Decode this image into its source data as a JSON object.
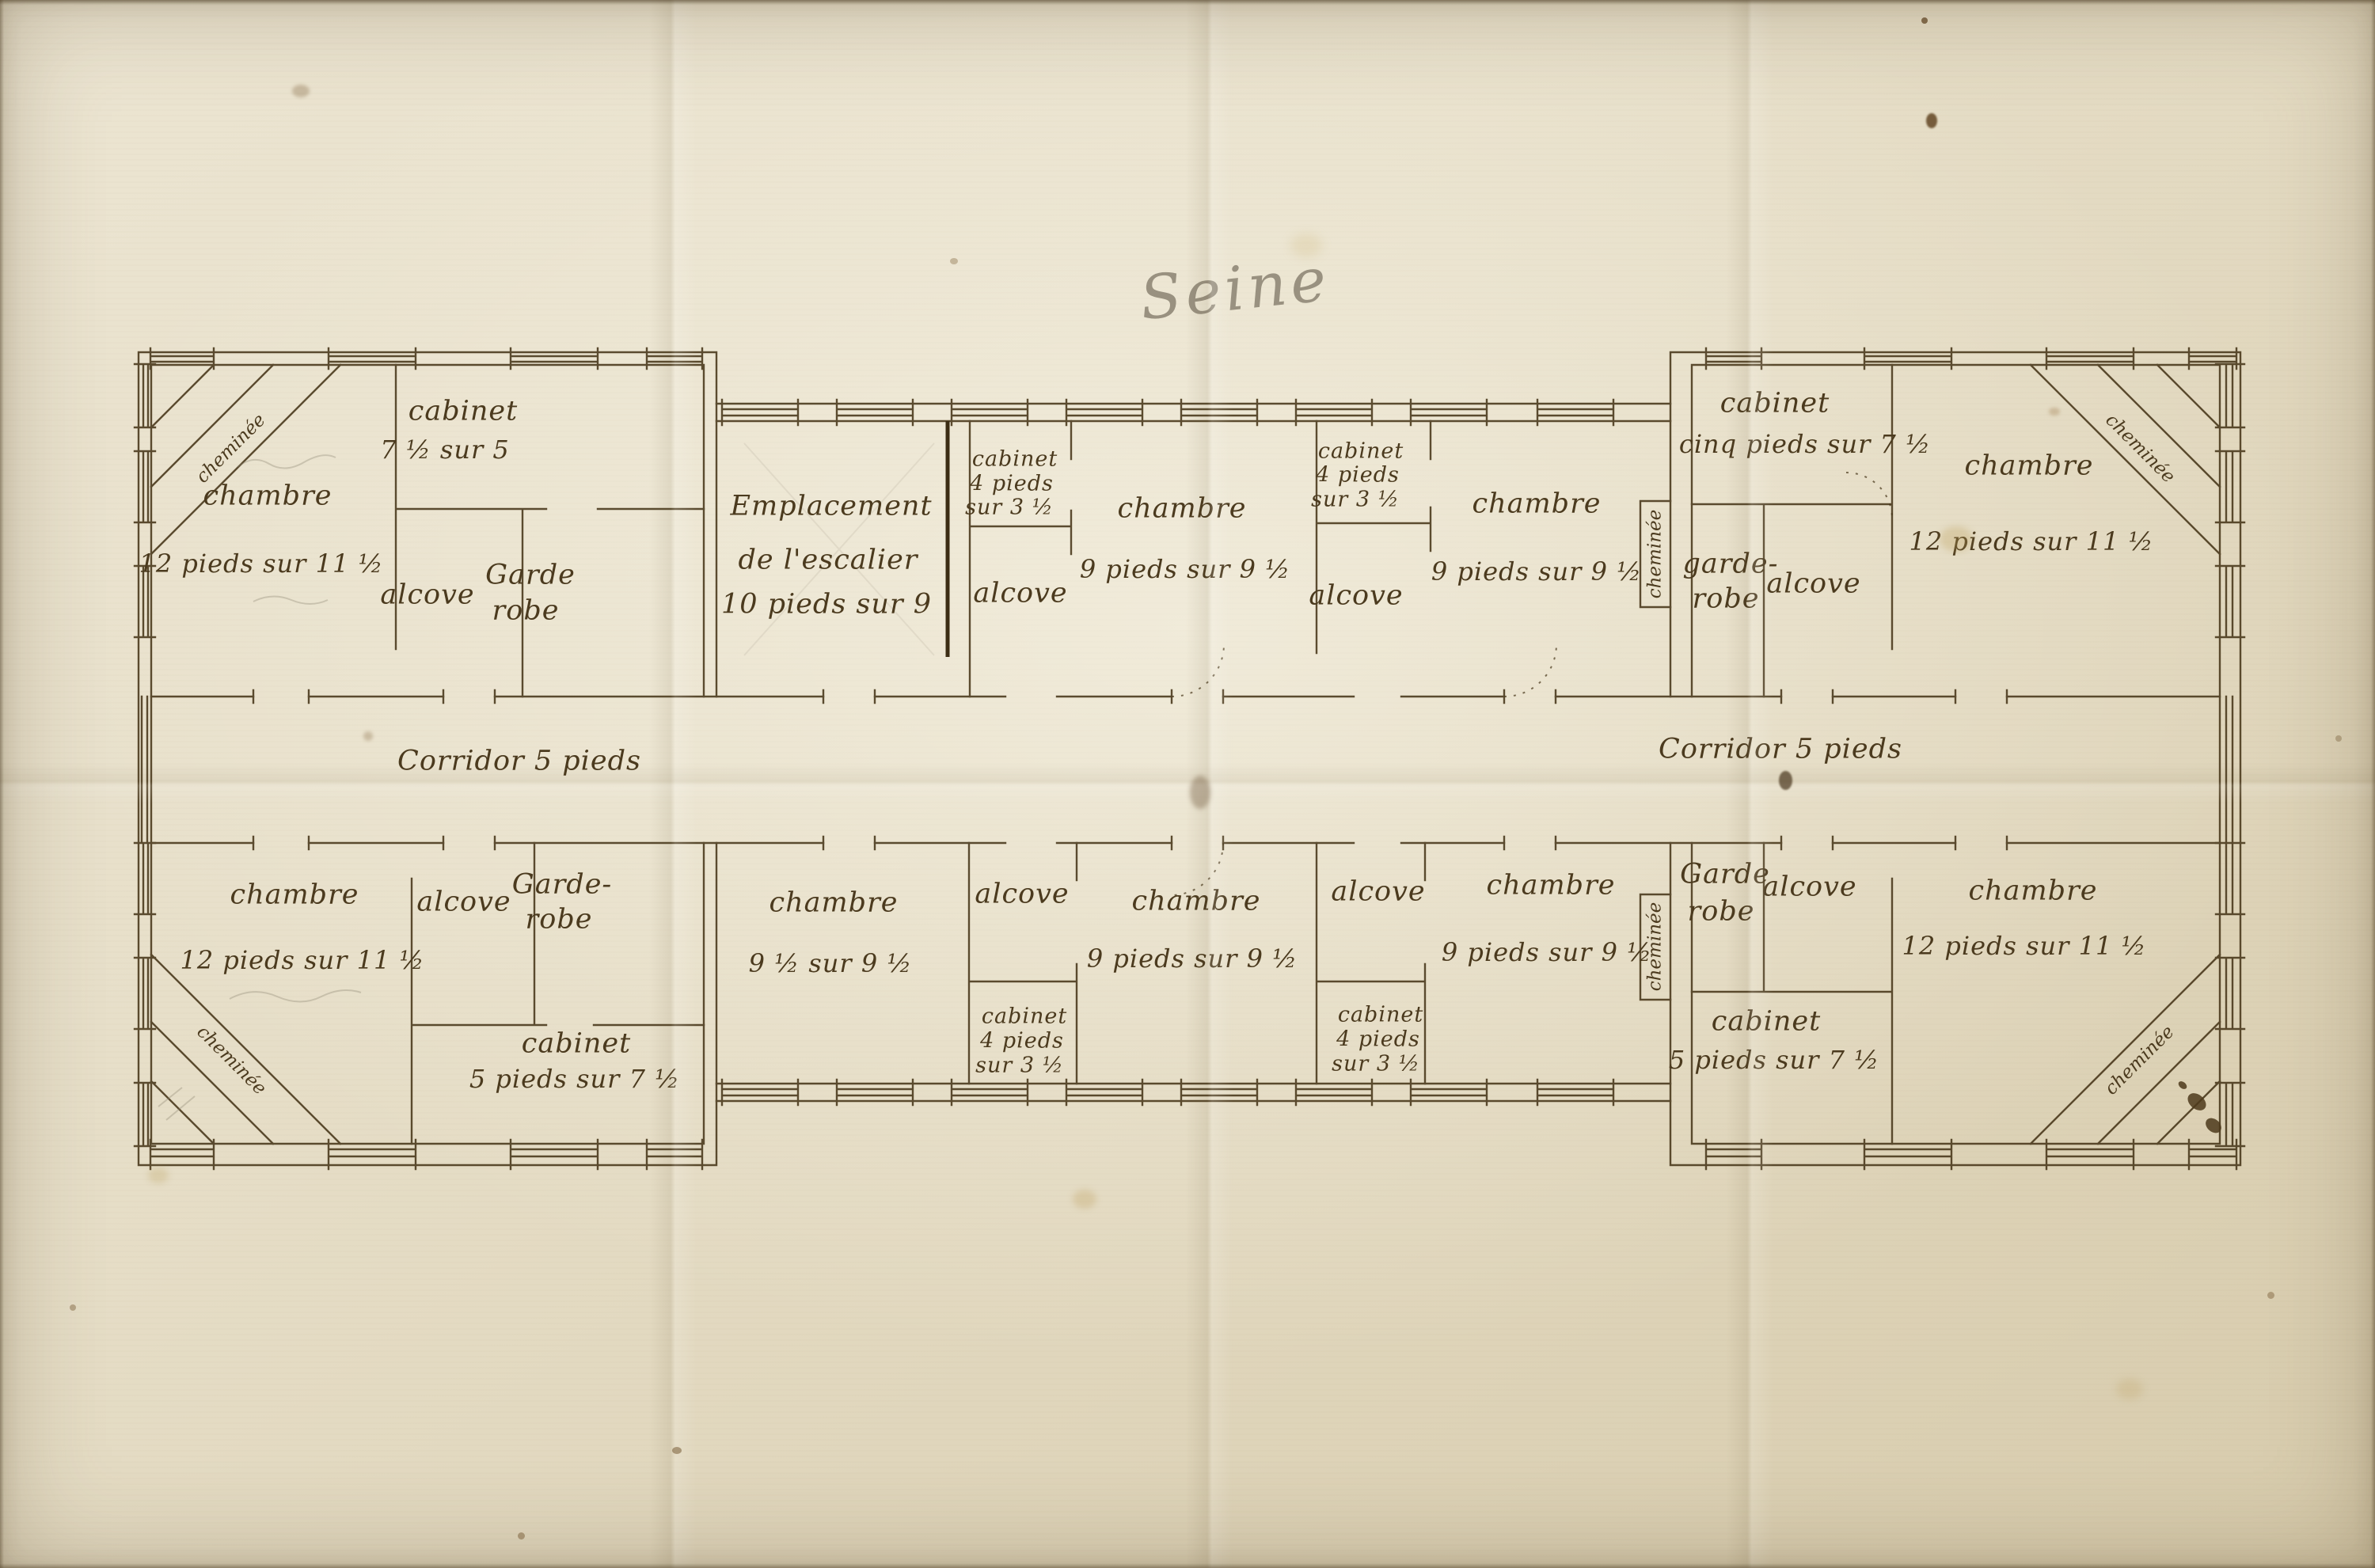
{
  "title": "Seine",
  "palette": {
    "paper": "#e7dfc9",
    "ink": "#4b3a1e",
    "pencil": "#8b8372"
  },
  "corridor": {
    "left": "Corridor 5 pieds",
    "right": "Corridor 5 pieds"
  },
  "chimney_label": "cheminée",
  "rooms": {
    "tl_cabinet": {
      "name": "cabinet",
      "dims": "7 ½ sur 5"
    },
    "tl_chambre": {
      "name": "chambre",
      "dims": "12 pieds sur 11 ½"
    },
    "tl_alcove": {
      "name": "alcove"
    },
    "tl_garderobe": {
      "line1": "Garde",
      "line2": "robe"
    },
    "stair": {
      "line1": "Emplacement",
      "line2": "de l'escalier",
      "line3": "10 pieds sur 9"
    },
    "top_cabinet_1": {
      "line1": "cabinet",
      "line2": "4 pieds",
      "line3": "sur 3 ½"
    },
    "top_alcove_1": {
      "name": "alcove"
    },
    "top_chambre_1": {
      "name": "chambre",
      "dims": "9 pieds sur 9 ½"
    },
    "top_cabinet_2": {
      "line1": "cabinet",
      "line2": "4 pieds",
      "line3": "sur 3 ½"
    },
    "top_alcove_2": {
      "name": "alcove"
    },
    "top_chambre_2": {
      "name": "chambre",
      "dims": "9 pieds sur 9 ½"
    },
    "tr_cabinet": {
      "name": "cabinet",
      "dims": "cinq pieds sur 7 ½"
    },
    "tr_garderobe": {
      "line1": "garde-",
      "line2": "robe"
    },
    "tr_alcove": {
      "name": "alcove"
    },
    "tr_chambre": {
      "name": "chambre",
      "dims": "12 pieds sur 11 ½"
    },
    "bl_chambre": {
      "name": "chambre",
      "dims": "12 pieds sur 11 ½"
    },
    "bl_alcove": {
      "name": "alcove"
    },
    "bl_garderobe": {
      "line1": "Garde-",
      "line2": "robe"
    },
    "bl_cabinet": {
      "name": "cabinet",
      "dims": "5 pieds sur 7 ½"
    },
    "bot_chambre_1": {
      "name": "chambre",
      "dims": "9 ½ sur 9 ½"
    },
    "bot_alcove_1": {
      "name": "alcove"
    },
    "bot_cabinet_1": {
      "line1": "cabinet",
      "line2": "4 pieds",
      "line3": "sur 3 ½"
    },
    "bot_chambre_2": {
      "name": "chambre",
      "dims": "9 pieds sur 9 ½"
    },
    "bot_alcove_2": {
      "name": "alcove"
    },
    "bot_cabinet_2": {
      "line1": "cabinet",
      "line2": "4 pieds",
      "line3": "sur 3 ½"
    },
    "bot_chambre_3": {
      "name": "chambre",
      "dims": "9 pieds sur 9 ½"
    },
    "br_garderobe": {
      "line1": "Garde",
      "line2": "robe"
    },
    "br_alcove": {
      "name": "alcove"
    },
    "br_cabinet": {
      "name": "cabinet",
      "dims": "5 pieds sur 7 ½"
    },
    "br_chambre": {
      "name": "chambre",
      "dims": "12 pieds sur 11 ½"
    }
  }
}
